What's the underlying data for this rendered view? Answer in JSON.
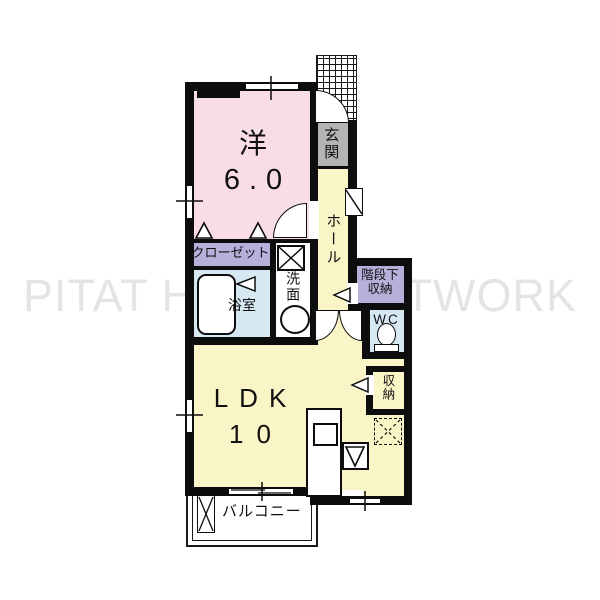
{
  "watermark": "PITAT HOUSE NETWORK",
  "rooms": {
    "western": {
      "name": "洋",
      "size": "6.0"
    },
    "ldk": {
      "name": "LDK",
      "size": "10"
    },
    "entrance": {
      "label": "玄関"
    },
    "hall": {
      "label": "ホール"
    },
    "closet": {
      "label": "クローゼット"
    },
    "bathroom": {
      "label": "浴室"
    },
    "washroom": {
      "label": "洗面"
    },
    "under_stairs": {
      "line1": "階段下",
      "line2": "収納"
    },
    "wc": {
      "label": "WC"
    },
    "storage": {
      "label": "収納"
    },
    "balcony": {
      "label": "バルコニー"
    }
  },
  "colors": {
    "pink": "#f8dce8",
    "yellow": "#faf5c6",
    "purple": "#b6b0da",
    "blue": "#d6e8f1",
    "gray": "#b4b4b4",
    "wall": "#0d0d0d",
    "watermark": "#e4e4e4"
  }
}
